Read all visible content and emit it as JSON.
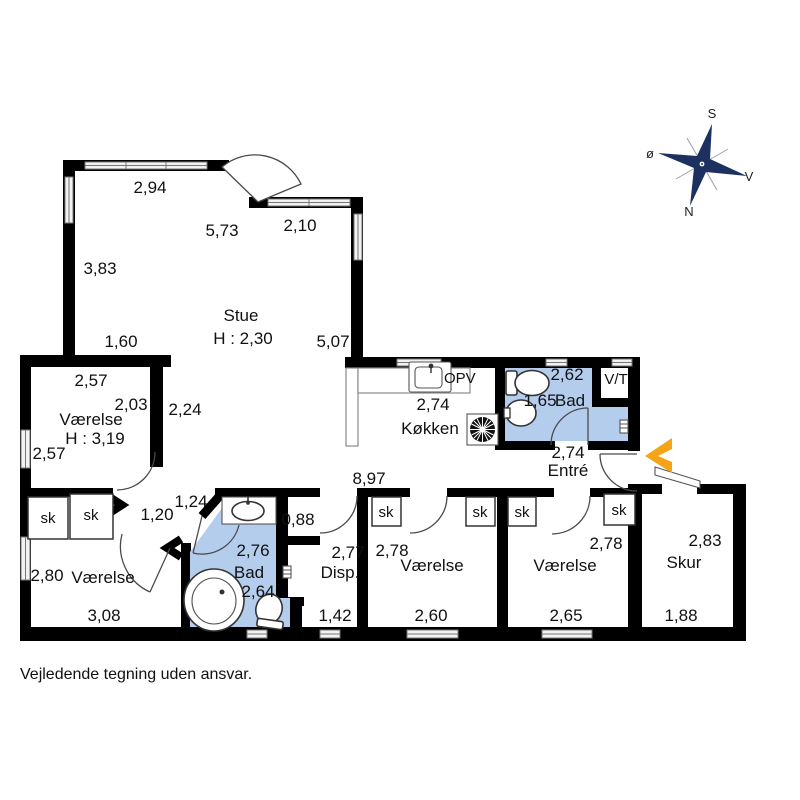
{
  "colors": {
    "wall": "#000000",
    "bath": "#b5cdec",
    "arrow": "#f4a417",
    "compass": "#1d3160",
    "window_stroke": "#777777",
    "text": "#111111"
  },
  "labels": {
    "stue_name": "Stue",
    "stue_height": "H : 2,30",
    "tl_room_name": "Værelse",
    "tl_room_height": "H : 3,19",
    "kitchen": "Køkken",
    "opv": "OPV",
    "bath_top": "Bad",
    "vt": "V/T",
    "entre": "Entré",
    "bath_bottom": "Bad",
    "disp": "Disp.",
    "room_bottom_left": "Værelse",
    "room_mid": "Værelse",
    "room_right": "Værelse",
    "skur": "Skur",
    "closet": "sk"
  },
  "dims": {
    "d294": "2,94",
    "d573": "5,73",
    "d210": "2,10",
    "d383": "3,83",
    "d507": "5,07",
    "d160": "1,60",
    "d257_top": "2,57",
    "d203": "2,03",
    "d257_left": "2,57",
    "d224": "2,24",
    "d274_kitchen": "2,74",
    "d262": "2,62",
    "d165": "1,65",
    "d274_entre": "2,74",
    "d897": "8,97",
    "d124": "1,24",
    "d120": "1,20",
    "d088": "0,88",
    "d276": "2,76",
    "d264": "2,64",
    "d277": "2,77",
    "d142": "1,42",
    "d278_mid": "2,78",
    "d260": "2,60",
    "d278_right": "2,78",
    "d265": "2,65",
    "d280": "2,80",
    "d308": "3,08",
    "d283": "2,83",
    "d188": "1,88"
  },
  "compass": {
    "top": "S",
    "left": "ø",
    "right": "V",
    "bottom": "N"
  },
  "footer": {
    "disclaimer": "Vejledende tegning uden ansvar."
  }
}
